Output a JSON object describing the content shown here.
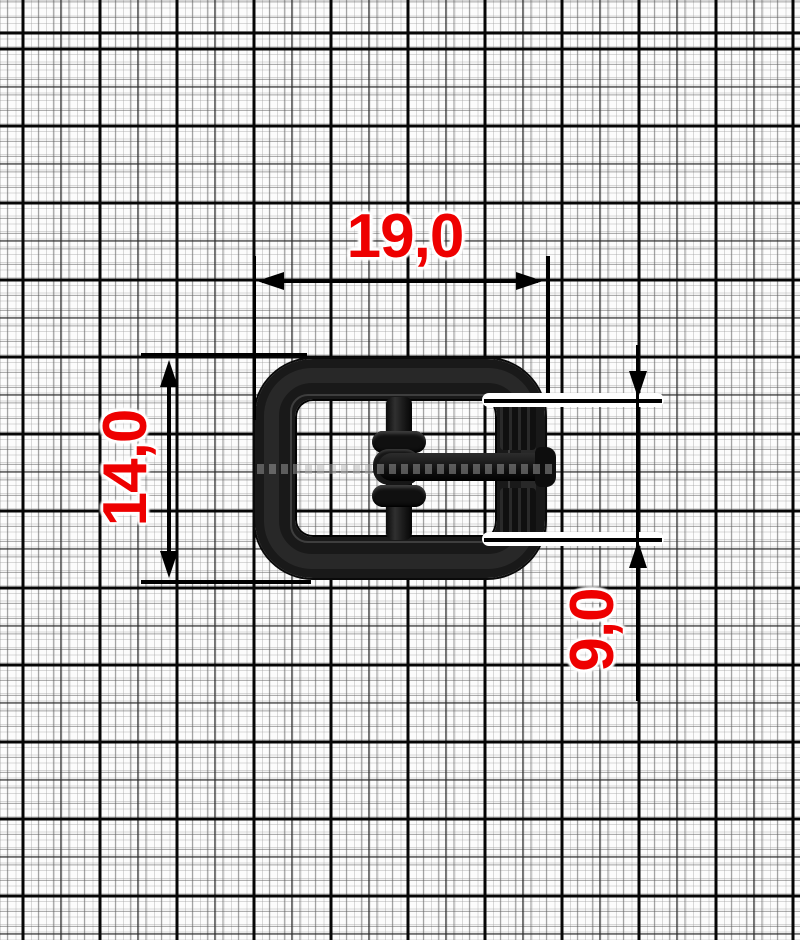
{
  "page": {
    "type": "product-dimension-diagram",
    "subject": "black metal pin buckle, top view, on millimeter graph paper"
  },
  "dimensions": {
    "width": {
      "label": "19,0",
      "value_mm": 19.0,
      "orientation": "horizontal",
      "measures": "overall buckle width"
    },
    "height": {
      "label": "14,0",
      "value_mm": 14.0,
      "orientation": "vertical",
      "measures": "overall buckle height"
    },
    "inner_height": {
      "label": "9,0",
      "value_mm": 9.0,
      "orientation": "vertical",
      "measures": "inner opening height at right side"
    }
  },
  "colors": {
    "dimension_text": "#ee0000",
    "dimension_line": "#000000",
    "buckle": "#191919",
    "grid_major": "#060606",
    "grid_minor": "#999999",
    "paper": "#fcfcfc"
  }
}
